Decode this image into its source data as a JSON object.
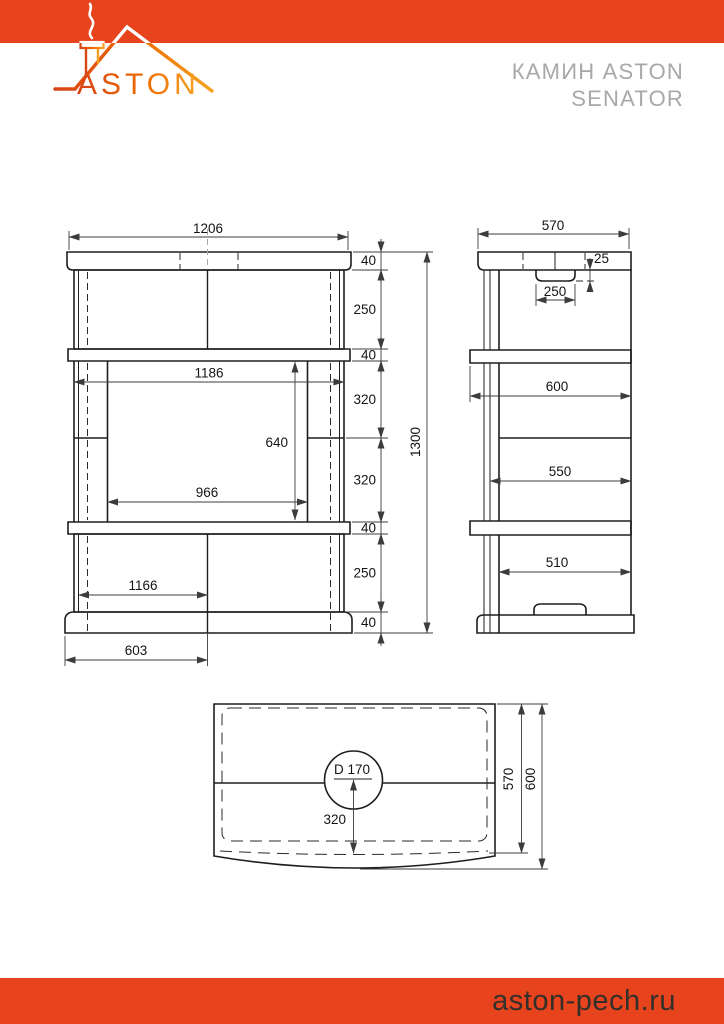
{
  "header": {
    "brand": "ASTON",
    "title_line1": "КАМИН ASTON",
    "title_line2": "SENATOR"
  },
  "footer": {
    "site": "aston-pech.ru"
  },
  "colors": {
    "accent": "#E7431C",
    "logo_gradient_start": "#D84315",
    "logo_gradient_end": "#F6A323",
    "title_gray": "#A8A8A8",
    "line": "#1E1E1E"
  },
  "front_view": {
    "overall_width": "1206",
    "overall_height": "1300",
    "body_width": "1186",
    "opening_width": "966",
    "opening_height": "640",
    "base_inner_width": "1166",
    "base_half_width": "603",
    "h1": "40",
    "h2": "250",
    "h3": "40",
    "h4": "320",
    "h5": "320",
    "h6": "40",
    "h7": "250",
    "h8": "40"
  },
  "side_view": {
    "depth": "570",
    "lintel_height": "25",
    "lintel_width": "250",
    "upper_depth": "600",
    "middle_depth": "550",
    "lower_depth": "510"
  },
  "top_view": {
    "flue": "D 170",
    "flue_offset": "320",
    "inner_depth": "570",
    "outer_depth": "600"
  }
}
